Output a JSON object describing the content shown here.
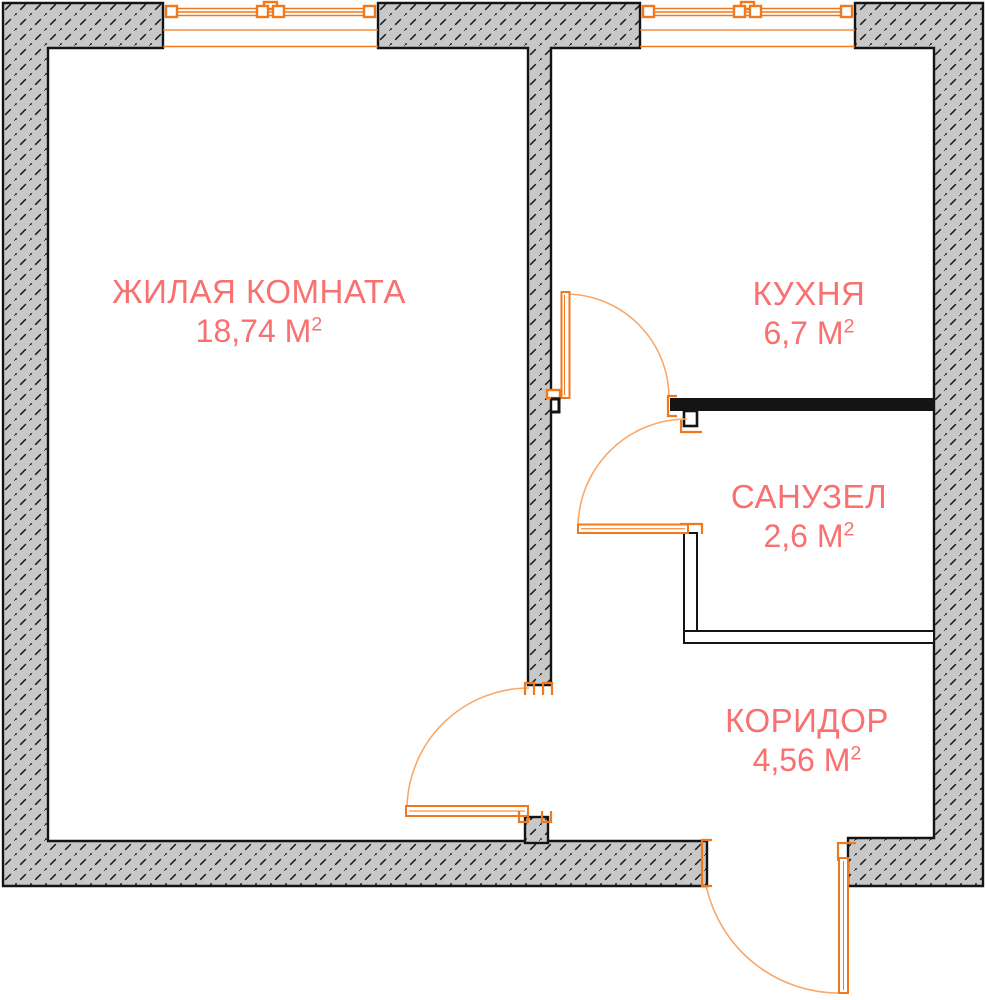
{
  "colors": {
    "wall_fill": "#c8c8c8",
    "wall_outline": "#141414",
    "window_door_orange": "#f0791d",
    "door_arc_orange": "#f9a869",
    "room_label_red": "#f8706f"
  },
  "rooms": [
    {
      "name": "ЖИЛАЯ КОМНАТА",
      "area_value": "18,74 М",
      "area_sup": "2"
    },
    {
      "name": "КУХНЯ",
      "area_value": "6,7 М",
      "area_sup": "2"
    },
    {
      "name": "САНУЗЕЛ",
      "area_value": "2,6 М",
      "area_sup": "2"
    },
    {
      "name": "КОРИДОР",
      "area_value": "4,56 М",
      "area_sup": "2"
    }
  ]
}
